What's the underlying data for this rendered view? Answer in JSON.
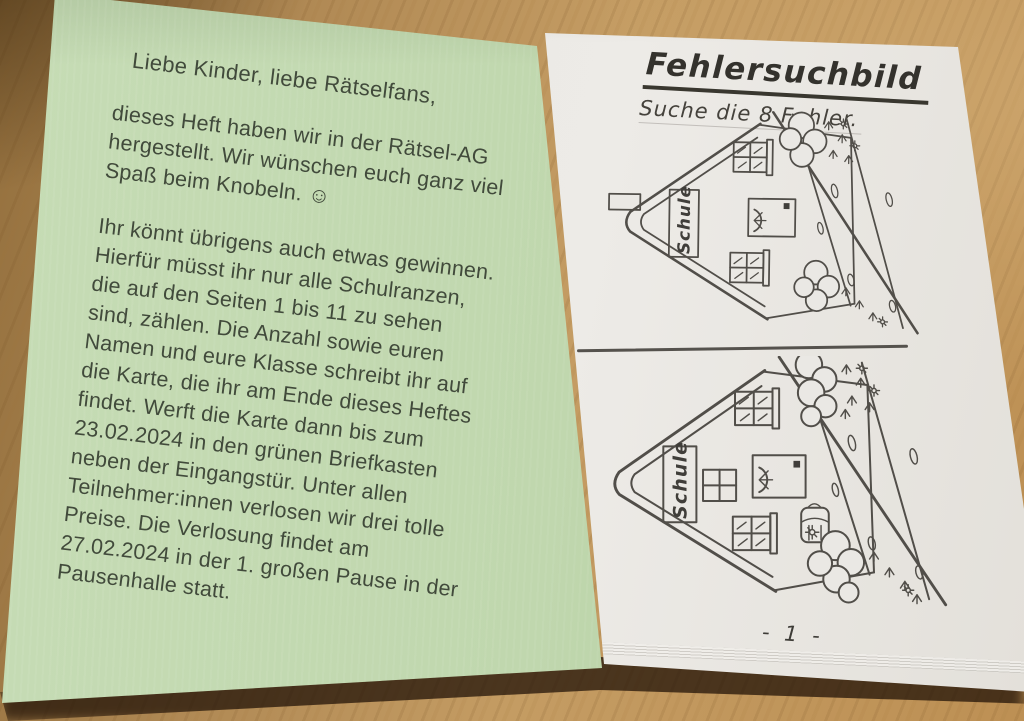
{
  "scene": {
    "table_wood_light": "#c49c63",
    "table_wood_dark": "#6e5124"
  },
  "booklet": {
    "left_page": {
      "paper_color": "#c0d7ae",
      "ink_color": "#414a3b",
      "salutation": "Liebe Kinder, liebe Rätselfans,",
      "intro_lines": [
        "dieses Heft haben wir in der Rätsel-AG",
        "hergestellt. Wir wünschen euch ganz viel",
        "Spaß beim Knobeln. ☺"
      ],
      "body_lines": [
        "Ihr könnt übrigens auch etwas gewinnen.",
        "Hierfür müsst ihr nur alle Schulranzen,",
        "die auf den Seiten 1 bis 11 zu sehen",
        "sind, zählen. Die Anzahl sowie euren",
        "Namen und eure Klasse schreibt ihr auf",
        "die Karte, die ihr am Ende dieses Heftes",
        "findet. Werft die Karte dann bis zum",
        "23.02.2024 in den grünen Briefkasten",
        "neben der Eingangstür. Unter allen",
        "Teilnehmer:innen verlosen wir drei tolle",
        "Preise. Die Verlosung findet am",
        "27.02.2024 in der 1. großen Pause in der",
        "Pausenhalle statt."
      ]
    },
    "right_page": {
      "paper_color": "#eae8e4",
      "pencil_color": "#514e49",
      "title": "Fehlersuchbild",
      "subtitle": "Suche die 8 Fehler.",
      "drawing_sign_text": "Schule",
      "page_number": "- 1 -"
    }
  }
}
